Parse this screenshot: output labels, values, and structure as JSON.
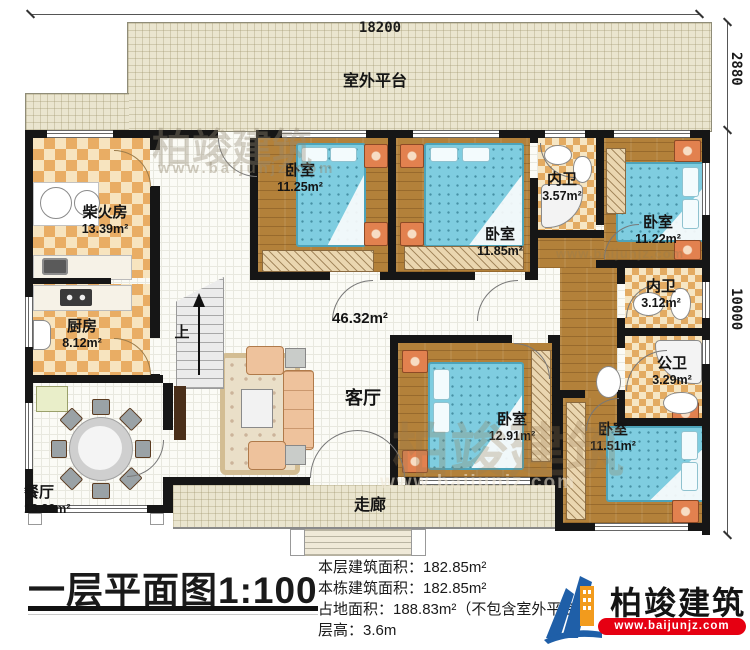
{
  "dimensions": {
    "total_width": "18200",
    "platform_depth": "2880",
    "house_depth": "10000"
  },
  "platform": {
    "label": "室外平台"
  },
  "rooms": {
    "firewood": {
      "name": "柴火房",
      "area": "13.39m²"
    },
    "kitchen": {
      "name": "厨房",
      "area": "8.12m²"
    },
    "dining": {
      "name": "餐厅",
      "area": "13.39m²"
    },
    "living": {
      "name": "客厅",
      "area": "46.32m²"
    },
    "corridor": {
      "name": "走廊"
    },
    "stairs": {
      "label": "上"
    },
    "bedroom_top_left": {
      "name": "卧室",
      "area": "11.25m²"
    },
    "bedroom_top_mid": {
      "name": "卧室",
      "area": "11.85m²"
    },
    "bedroom_top_right": {
      "name": "卧室",
      "area": "11.22m²"
    },
    "bedroom_bottom_mid": {
      "name": "卧室",
      "area": "12.91m²"
    },
    "bedroom_bottom_right": {
      "name": "卧室",
      "area": "11.51m²"
    },
    "bath_top": {
      "name": "内卫",
      "area": "3.57m²"
    },
    "bath_mid": {
      "name": "内卫",
      "area": "3.12m²"
    },
    "bath_public": {
      "name": "公卫",
      "area": "3.29m²"
    }
  },
  "title_block": {
    "title": "一层平面图1:100",
    "lines": [
      "本层建筑面积：182.85m²",
      "本栋建筑面积：182.85m²",
      "占地面积：188.83m²（不包含室外平台）",
      "层高：3.6m"
    ]
  },
  "logo": {
    "brand": "柏竣建筑",
    "site": "www.baijunjz.com"
  },
  "watermark": {
    "brand": "柏竣建筑",
    "site": "www.baijunjz.com"
  },
  "colors": {
    "wall": "#161616",
    "bed": "#7fcde0",
    "checker": "#e9ad64",
    "wood": "#b3813a",
    "logo_red": "#e60012"
  }
}
